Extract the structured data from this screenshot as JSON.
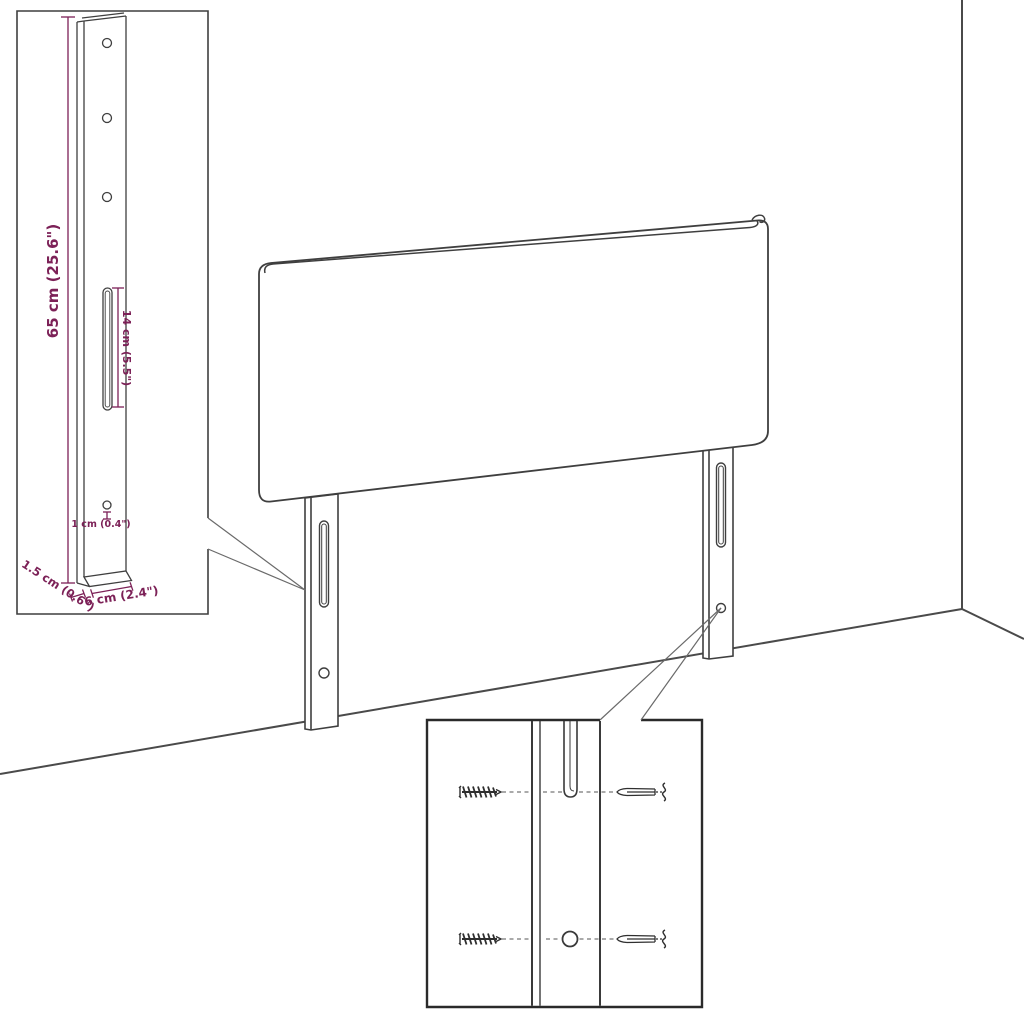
{
  "diagram": {
    "title": "headboard-with-mounting-brackets-dimension-diagram",
    "colors": {
      "dimension_accent": "#7c2157",
      "line": "#3f3f3f"
    },
    "labels": {
      "bracket_height": "65 cm (25.6\")",
      "slot_length": "14 cm (5.5\")",
      "hole_diameter": "1 cm (0.4\")",
      "bracket_depth": "1.5 cm (0.6\")",
      "bracket_width": "6 cm (2.4\")"
    },
    "components": {
      "headboard": "upholstered-headboard-panel",
      "left_leg": "left-mounting-bracket",
      "right_leg": "right-mounting-bracket",
      "inset": "bracket-dimension-callout",
      "hardware": "screw-and-plug-mounting-detail"
    }
  }
}
